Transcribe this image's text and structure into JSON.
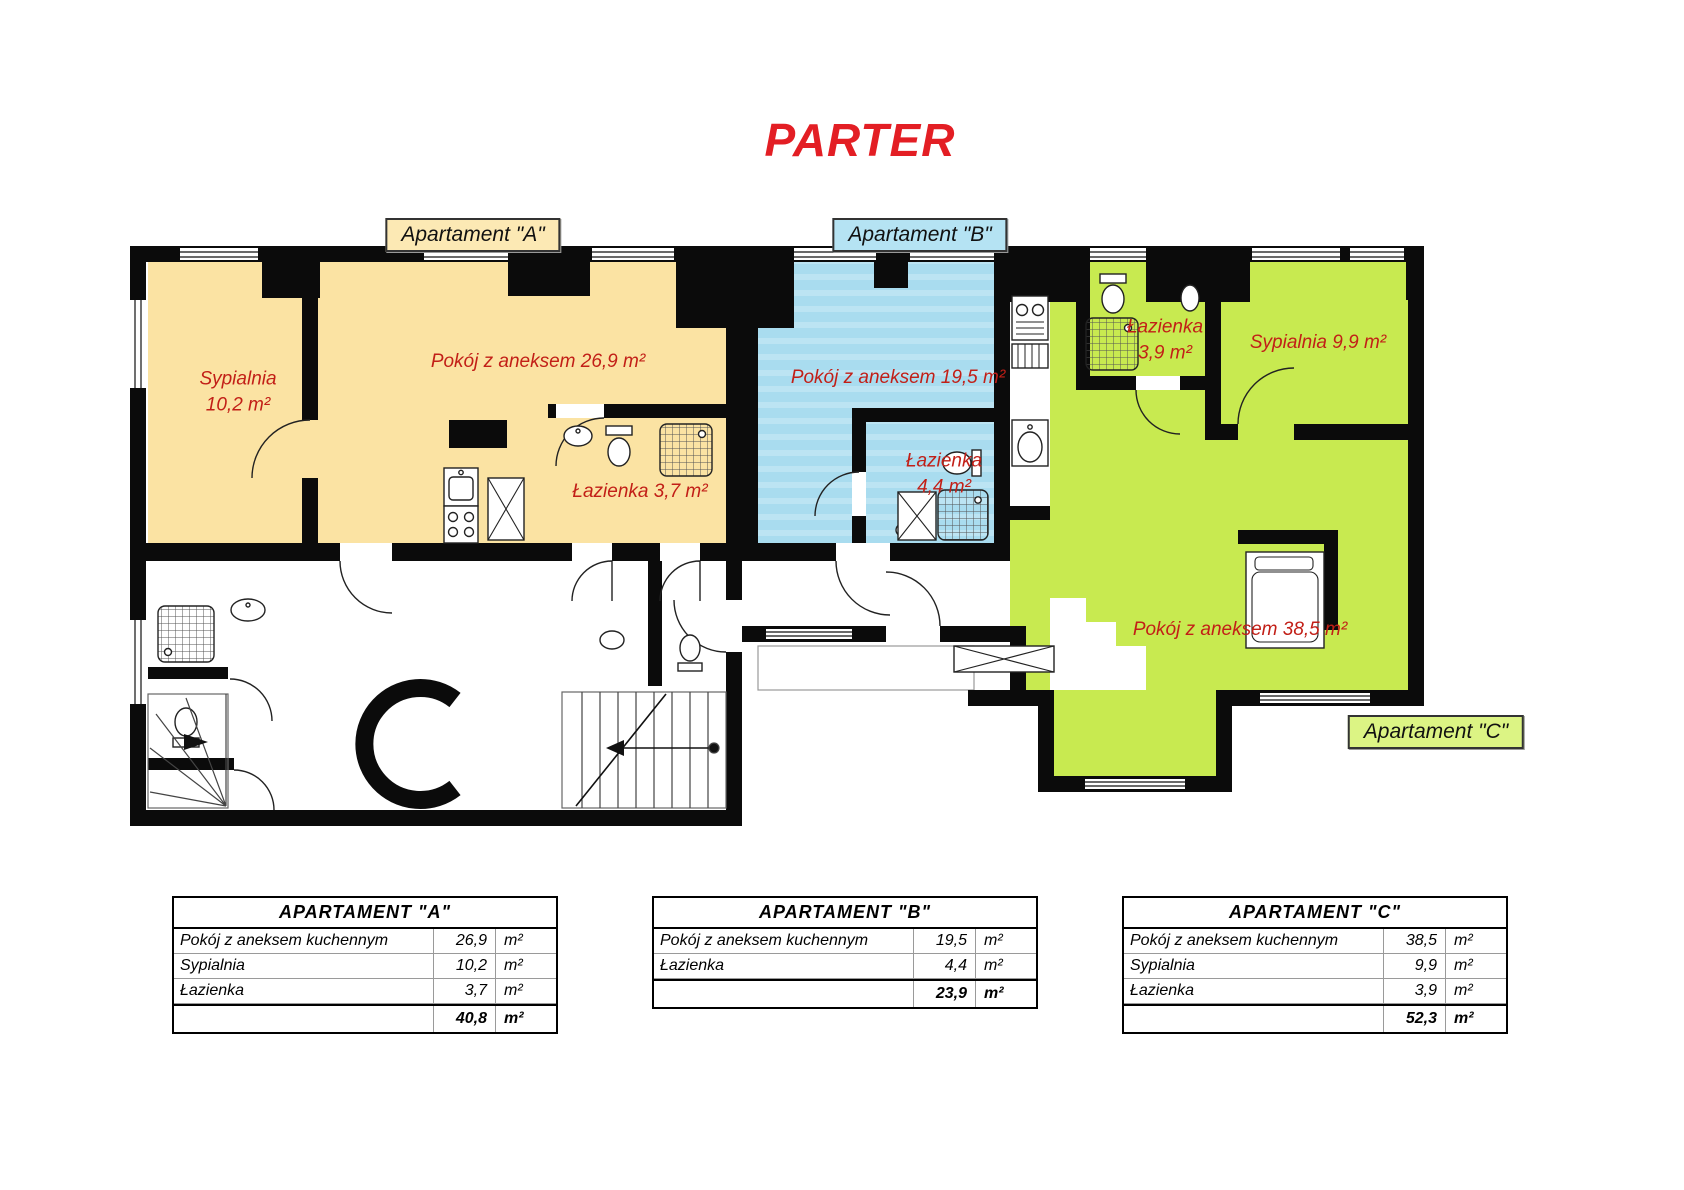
{
  "title": "PARTER",
  "colors": {
    "apt-a": "#FBE3A3",
    "apt-b": "#A9DCEF",
    "apt-c": "#C8EA50",
    "label-a-bg": "#FCE9B4",
    "label-b-bg": "#B5E3F3",
    "label-c-bg": "#DCF484",
    "red": "#C21F17",
    "title-red": "#E31E24",
    "wall": "#0B0B0B"
  },
  "labels": {
    "apartment_a": "Apartament \"A\"",
    "apartment_b": "Apartament \"B\"",
    "apartment_c": "Apartament \"C\""
  },
  "rooms": {
    "a_sypialnia_1": "Sypialnia",
    "a_sypialnia_2": "10,2 m²",
    "a_pokoj": "Pokój z aneksem 26,9 m²",
    "a_lazienka": "Łazienka 3,7 m²",
    "b_pokoj": "Pokój z aneksem 19,5 m²",
    "b_lazienka_1": "Łazienka",
    "b_lazienka_2": "4,4 m²",
    "c_lazienka_1": "Łazienka",
    "c_lazienka_2": "3,9 m²",
    "c_sypialnia": "Sypialnia 9,9 m²",
    "c_pokoj": "Pokój z aneksem 38,5 m²"
  },
  "tables": {
    "a": {
      "header": "APARTAMENT \"A\"",
      "rows": [
        {
          "name": "Pokój z aneksem kuchennym",
          "value": "26,9",
          "unit": "m²"
        },
        {
          "name": "Sypialnia",
          "value": "10,2",
          "unit": "m²"
        },
        {
          "name": "Łazienka",
          "value": "3,7",
          "unit": "m²"
        }
      ],
      "total": {
        "value": "40,8",
        "unit": "m²"
      }
    },
    "b": {
      "header": "APARTAMENT \"B\"",
      "rows": [
        {
          "name": "Pokój z aneksem kuchennym",
          "value": "19,5",
          "unit": "m²"
        },
        {
          "name": "Łazienka",
          "value": "4,4",
          "unit": "m²"
        }
      ],
      "total": {
        "value": "23,9",
        "unit": "m²"
      }
    },
    "c": {
      "header": "APARTAMENT \"C\"",
      "rows": [
        {
          "name": "Pokój z aneksem kuchennym",
          "value": "38,5",
          "unit": "m²"
        },
        {
          "name": "Sypialnia",
          "value": "9,9",
          "unit": "m²"
        },
        {
          "name": "Łazienka",
          "value": "3,9",
          "unit": "m²"
        }
      ],
      "total": {
        "value": "52,3",
        "unit": "m²"
      }
    }
  }
}
